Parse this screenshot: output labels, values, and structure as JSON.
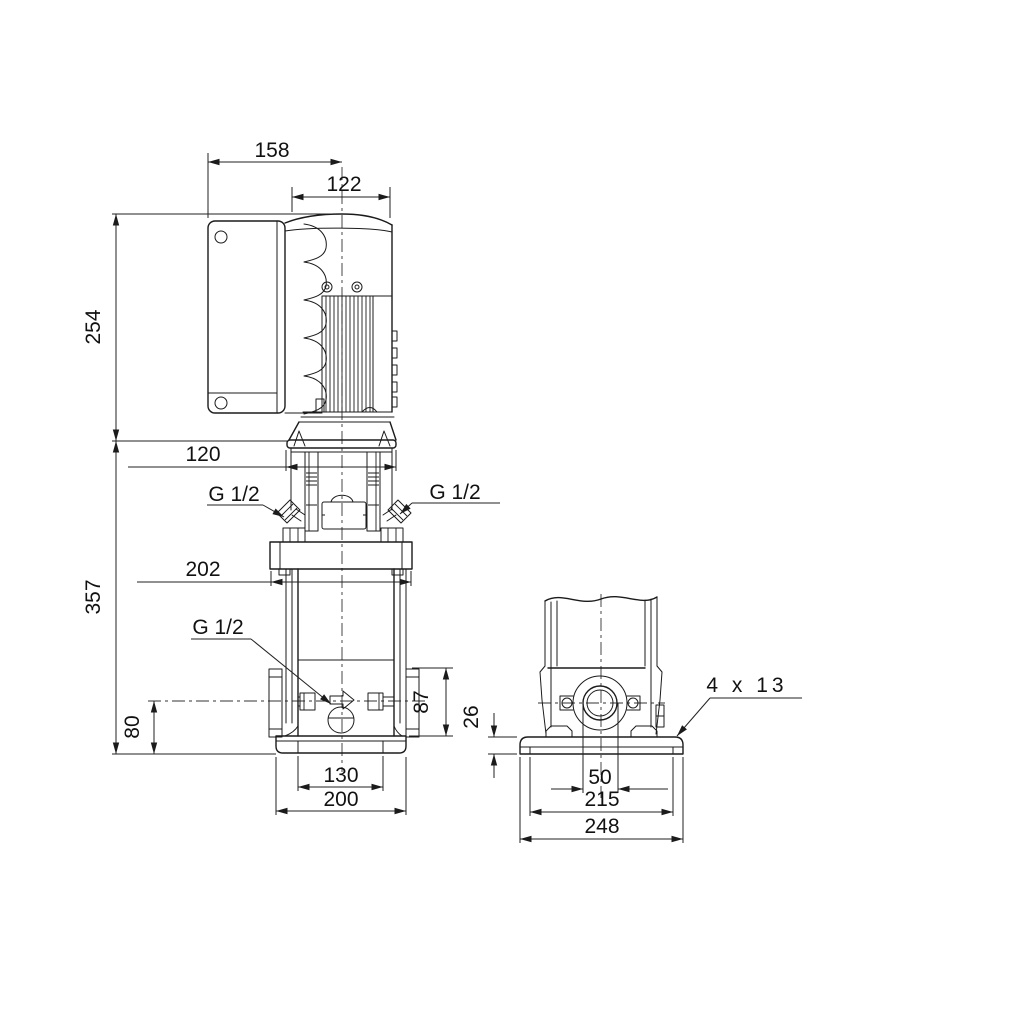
{
  "page": {
    "background": "#ffffff",
    "line_color": "#1b1b1b"
  },
  "drawing": {
    "front_view": {
      "dimensions": {
        "control_box_overhang": "158",
        "motor_width": "122",
        "motor_section_height": "254",
        "motor_stool_width": "120",
        "pump_section_height": "357",
        "head_flange_width": "202",
        "port_center_to_base": "80",
        "port_flange_height": "87",
        "base_slot_spacing": "130",
        "base_width": "200",
        "gauge_port_left": "G 1/2",
        "gauge_port_right": "G 1/2",
        "drain_port": "G 1/2"
      }
    },
    "side_view": {
      "dimensions": {
        "base_plate_height": "26",
        "mounting_holes": "4 x 13",
        "port_diameter": "50",
        "bolt_hole_spacing": "215",
        "base_depth": "248"
      }
    }
  }
}
